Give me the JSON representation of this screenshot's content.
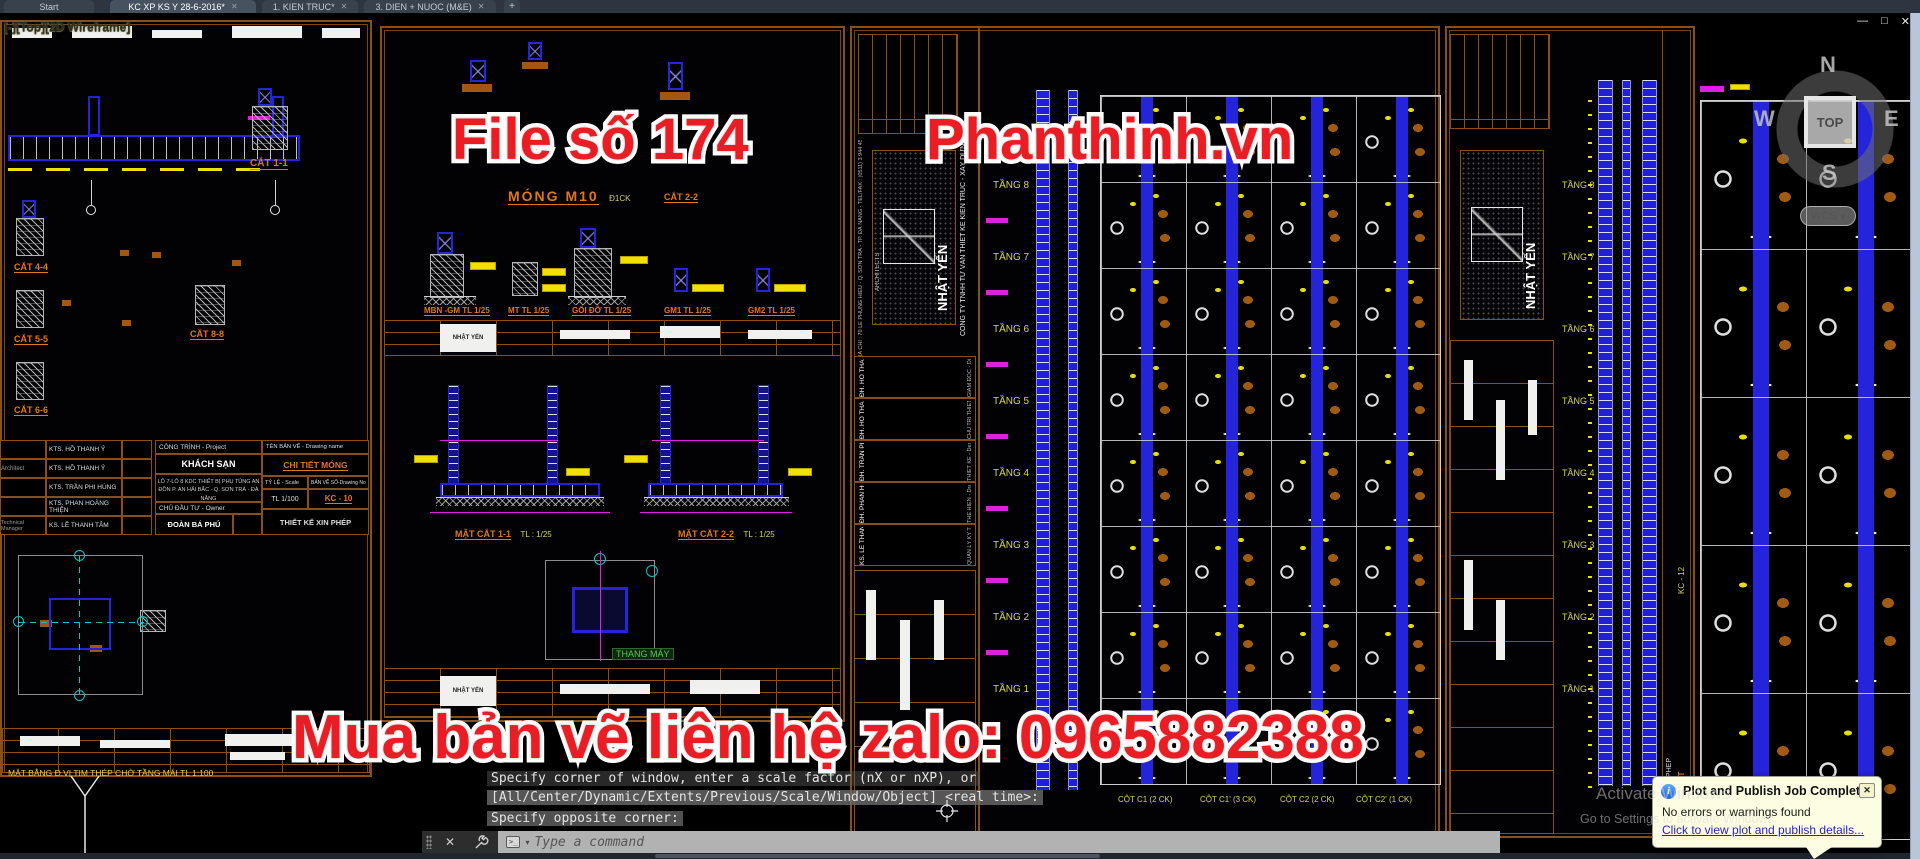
{
  "tabbar": {
    "tabs": [
      {
        "label": "Start"
      },
      {
        "label": "KC XP KS Y 28-6-2016*",
        "active": true
      },
      {
        "label": "1. KIEN TRUC*"
      },
      {
        "label": "3. DIEN + NUOC (M&E)"
      }
    ],
    "close_glyph": "✕",
    "new_tab": "+"
  },
  "window_controls": {
    "minimize": "—",
    "restore": "□",
    "close": "✕"
  },
  "viewport_label": "[-][Top][2D Wireframe]",
  "watermarks": {
    "left": "File số 174",
    "right": "Phanthinh.vn",
    "bottom": "Mua bản vẽ liên hệ zalo: 0965882388",
    "color": "#ea1c24"
  },
  "viewcube": {
    "n": "N",
    "w": "W",
    "e": "E",
    "s": "S",
    "top": "TOP",
    "wcs": "WCS",
    "wcs_caret": "▾"
  },
  "command": {
    "history": [
      "Specify corner of window, enter a scale factor (nX or nXP), or",
      "[All/Center/Dynamic/Extents/Previous/Scale/Window/Object] <real time>:",
      "Specify opposite corner:"
    ],
    "placeholder": "Type a command",
    "prompt_icon": ">_",
    "caret": "▾",
    "close_glyph": "✕"
  },
  "notification": {
    "title": "Plot and Publish Job Complete",
    "body": "No errors or warnings found",
    "link": "Click to view plot and publish details...",
    "close": "✕",
    "info_glyph": "i"
  },
  "activate": {
    "line1": "Activate Windows",
    "line2": "Go to Settings to activate Windows."
  },
  "sheet_left": {
    "detail_labels": [
      "CẮT 1-1",
      "CẮT 4-4",
      "CẮT 5-5",
      "CẮT 6-6",
      "CẮT 8-8"
    ],
    "plan_label": "MẶT BẰNG Đ.VỊ TIM THÉP CHỜ TẦNG MÁI TL 1:100",
    "personnel": [
      {
        "role": "",
        "name": "KTS. HỒ THANH Ỷ"
      },
      {
        "role": "Architect",
        "name": "KTS. HỒ THANH Ỷ"
      },
      {
        "role": "",
        "name": "KTS. TRẦN PHI HÙNG"
      },
      {
        "role": "",
        "name": "KTS. PHAN HOÀNG THIỆN"
      },
      {
        "role": "Technical Manager",
        "name": "KS. LÊ THANH TÂM"
      }
    ],
    "title_block": {
      "project_label": "CÔNG TRÌNH - Project",
      "project_name": "KHÁCH SẠN",
      "project_address": "LÔ 7-LÔ 8 KDC THIẾT BỊ PHỤ TÙNG AN ĐỒN P. AN HẢI BẮC - Q. SƠN TRÀ - ĐÀ NẴNG",
      "owner_label": "CHỦ ĐẦU TƯ - Owner",
      "owner_name": "ĐOÀN BÁ PHÚ",
      "drawing_label": "TÊN BẢN VẼ - Drawing name",
      "drawing_name": "CHI TIẾT MÓNG",
      "scale_label": "TỶ LỆ - Scale",
      "scale_value": "TL 1/100",
      "number_label": "BẢN VẼ SỐ-Drawing No",
      "number_value": "KC - 10",
      "permit": "THIẾT KẾ XIN PHÉP"
    }
  },
  "sheet_mid": {
    "title": "MÓNG M10",
    "title_suffix": "Đ1CK",
    "cat22": "CẮT 2-2",
    "detail_labels": [
      "MBN -GM TL 1/25",
      "MT TL 1/25",
      "GỐI ĐỠ TL 1/25",
      "GM1 TL 1/25",
      "GM2 TL 1/25"
    ],
    "section1": "MẶT CẮT 1-1",
    "section1_scale": "TL : 1/25",
    "section2": "MẶT CẮT 2-2",
    "section2_scale": "TL : 1/25",
    "elevator": "THANG MÁY"
  },
  "firm": {
    "company": "CÔNG TY TNHH TƯ VẤN THIẾT KẾ KIẾN TRÚC - XÂY DỰNG",
    "stamp": "NHẬT YẾN",
    "stamp_sub": "ARCHITECTS",
    "address": "ĐỊA CHỈ : 70 LÊ PHỤNG HIỂU - Q. SƠN TRÀ - TP. ĐÀ NẴNG - TEL/FAX : (0511) 3 944 456",
    "roles": [
      "GIÁM ĐỐC - Director",
      "CHỦ TRÌ THIẾT KẾ - Principal Architect",
      "THIẾT KẾ - Designed by",
      "THỂ HIỆN - Drawn by",
      "QUẢN LÝ KỸ THUẬT - Technical Manager"
    ],
    "names": [
      "ĐH. HỒ THANH Ỷ",
      "ĐH. HỒ THANH Ỷ",
      "ĐH. TRẦN PHI HÙNG",
      "ĐH. PHAN HOÀNG THIỆN",
      "KS. LÊ THANH TÂM"
    ]
  },
  "floors": [
    "TẦNG 8",
    "TẦNG 7",
    "TẦNG 6",
    "TẦNG 5",
    "TẦNG 4",
    "TẦNG 3",
    "TẦNG 2",
    "TẦNG 1"
  ],
  "columns": [
    "CỘT C1 (2 CK)",
    "CỘT C1' (3 CK)",
    "CỘT C2 (2 CK)",
    "CỘT C2' (1 CK)"
  ],
  "sheet_col2": {
    "drawing_name": "CHI TIẾT CỘT",
    "drawing_no": "KC - 12",
    "permit": "THIẾT KẾ XIN PHÉP"
  }
}
